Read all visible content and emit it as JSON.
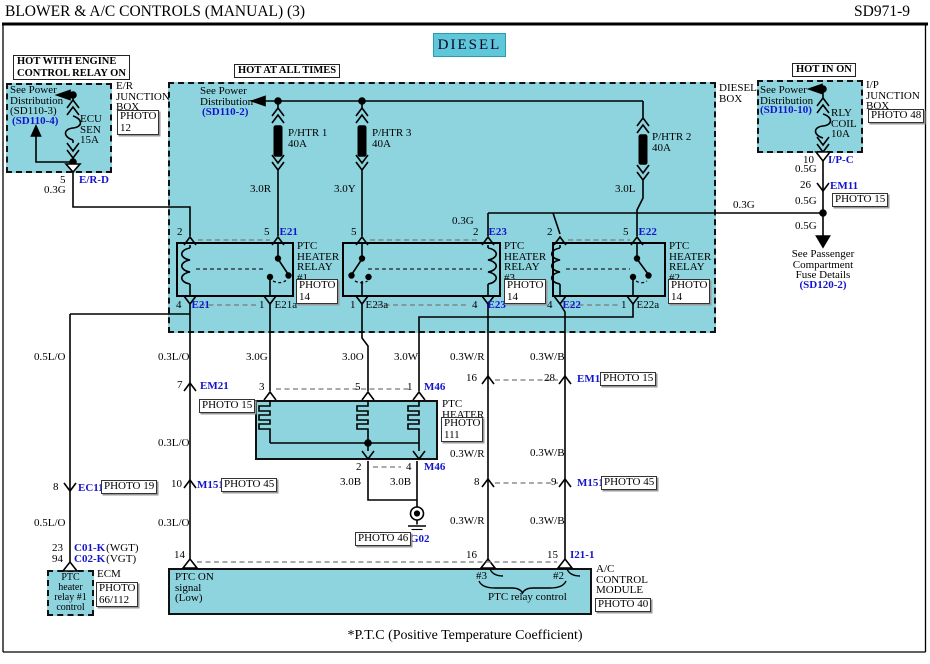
{
  "header": {
    "title": "BLOWER & A/C CONTROLS (MANUAL) (3)",
    "code": "SD971-9"
  },
  "banner": {
    "diesel": "DIESEL"
  },
  "sources": {
    "hot_engine": "HOT WITH ENGINE\nCONTROL RELAY ON",
    "hot_all": "HOT AT ALL TIMES",
    "hot_in_on": "HOT IN ON"
  },
  "boxes": {
    "er": "E/R\nJUNCTION\nBOX",
    "ip": "I/P\nJUNCTION\nBOX",
    "diesel": "DIESEL\nBOX",
    "ecm": "ECM",
    "acm": "A/C\nCONTROL\nMODULE",
    "ptc_heater": "PTC\nHEATER",
    "ptc_ctrl": "PTC\nheater\nrelay #1\ncontrol"
  },
  "relays": {
    "r1": "PTC\nHEATER\nRELAY\n#1",
    "r3": "PTC\nHEATER\nRELAY\n#3",
    "r2": "PTC\nHEATER\nRELAY\n#2"
  },
  "fuses": {
    "ecu_sen": "ECU\nSEN\n15A",
    "rly_coil": "RLY\nCOIL\n10A",
    "phtr1": "P/HTR 1\n40A",
    "phtr2": "P/HTR 2\n40A",
    "phtr3": "P/HTR 3\n40A"
  },
  "see": {
    "dist_l": "See Power\nDistribution\n(SD110-3)",
    "dist_l2": "(SD110-4)",
    "dist_c": "See Power\nDistribution",
    "dist_c2": "(SD110-2)",
    "dist_r": "See Power\nDistribution",
    "dist_r2": "(SD110-10)",
    "pass": "See Passenger\nCompartment\nFuse Details",
    "pass2": "(SD120-2)"
  },
  "wires": {
    "w05lo": "0.5L/O",
    "w03lo": "0.3L/O",
    "w03g": "0.3G",
    "w05g": "0.5G",
    "w30r": "3.0R",
    "w30y": "3.0Y",
    "w30l": "3.0L",
    "w30g": "3.0G",
    "w30o": "3.0O",
    "w30w": "3.0W",
    "w30b": "3.0B",
    "w03wr": "0.3W/R",
    "w03wb": "0.3W/B"
  },
  "pins": {
    "n1": "1",
    "n2": "2",
    "n3": "3",
    "n4": "4",
    "n5": "5",
    "n7": "7",
    "n8": "8",
    "n9": "9",
    "n10": "10",
    "n14": "14",
    "n15": "15",
    "n16": "16",
    "n23": "23",
    "n26": "26",
    "n28": "28",
    "n94": "94",
    "h3": "#3",
    "h2": "#2"
  },
  "conns": {
    "e21": "E21",
    "e21a": "E21a",
    "e22": "E22",
    "e22a": "E22a",
    "e23": "E23",
    "e23a": "E23a",
    "m46": "M46",
    "em21": "EM21",
    "em11": "EM11",
    "m151": "M151",
    "ec11": "EC11",
    "erd": "E/R-D",
    "ipc": "I/P-C",
    "i211": "I21-1",
    "g02": "G02",
    "c01": "C01-K",
    "c02": "C02-K",
    "wgt": "(WGT)",
    "vgt": "(VGT)"
  },
  "photos": {
    "p12": "PHOTO\n12",
    "p14": "PHOTO\n14",
    "p15": "PHOTO 15",
    "p19": "PHOTO 19",
    "p40": "PHOTO 40",
    "p45": "PHOTO 45",
    "p46": "PHOTO 46",
    "p48": "PHOTO 48",
    "p66": "PHOTO\n66/112",
    "p111": "PHOTO\n111"
  },
  "module": {
    "ptc_on": "PTC ON\nsignal\n(Low)",
    "relay_ctrl": "PTC relay control"
  },
  "colors": {
    "cyan": "#8ed4de",
    "cyan_dark": "#5ec7d9",
    "blue": "#1414cc"
  },
  "footnote": "*P.T.C  (Positive Temperature Coefficient)"
}
